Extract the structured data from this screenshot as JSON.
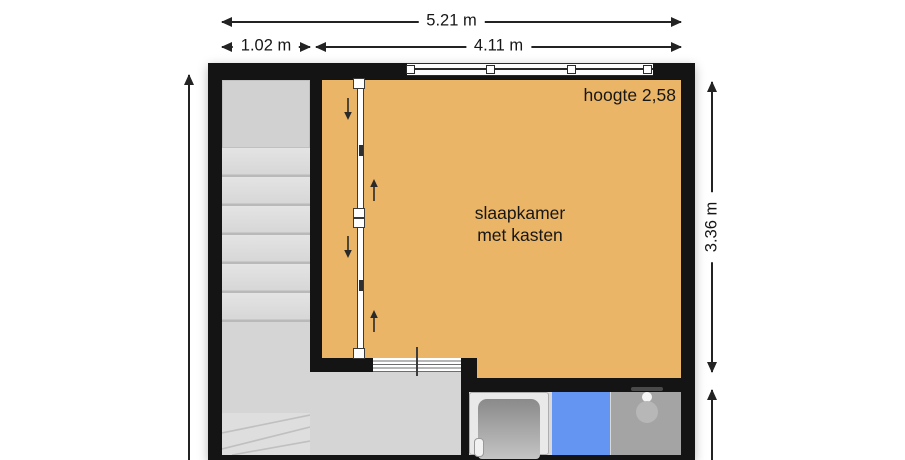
{
  "dimensions": {
    "total_width": "5.21 m",
    "stair_width": "1.02 m",
    "bedroom_width": "4.11 m",
    "bedroom_depth": "3.36 m"
  },
  "room": {
    "name_line1": "slaapkamer",
    "name_line2": "met kasten",
    "height_note": "hoogte 2,58"
  },
  "colors": {
    "wall": "#141414",
    "bedroom_fill": "#EAB566",
    "hall_fill": "#D5D5D5",
    "stair_tread": "#E0E0E0",
    "shower_blue": "#6495F3",
    "bathroom_gray": "#A4A4A4",
    "dimension_line": "#232323"
  },
  "icons": {
    "closet_slide_down": "arrow-down-icon",
    "closet_slide_up": "arrow-up-icon",
    "bath": "bathtub-icon",
    "shower": "shower-head-icon"
  }
}
